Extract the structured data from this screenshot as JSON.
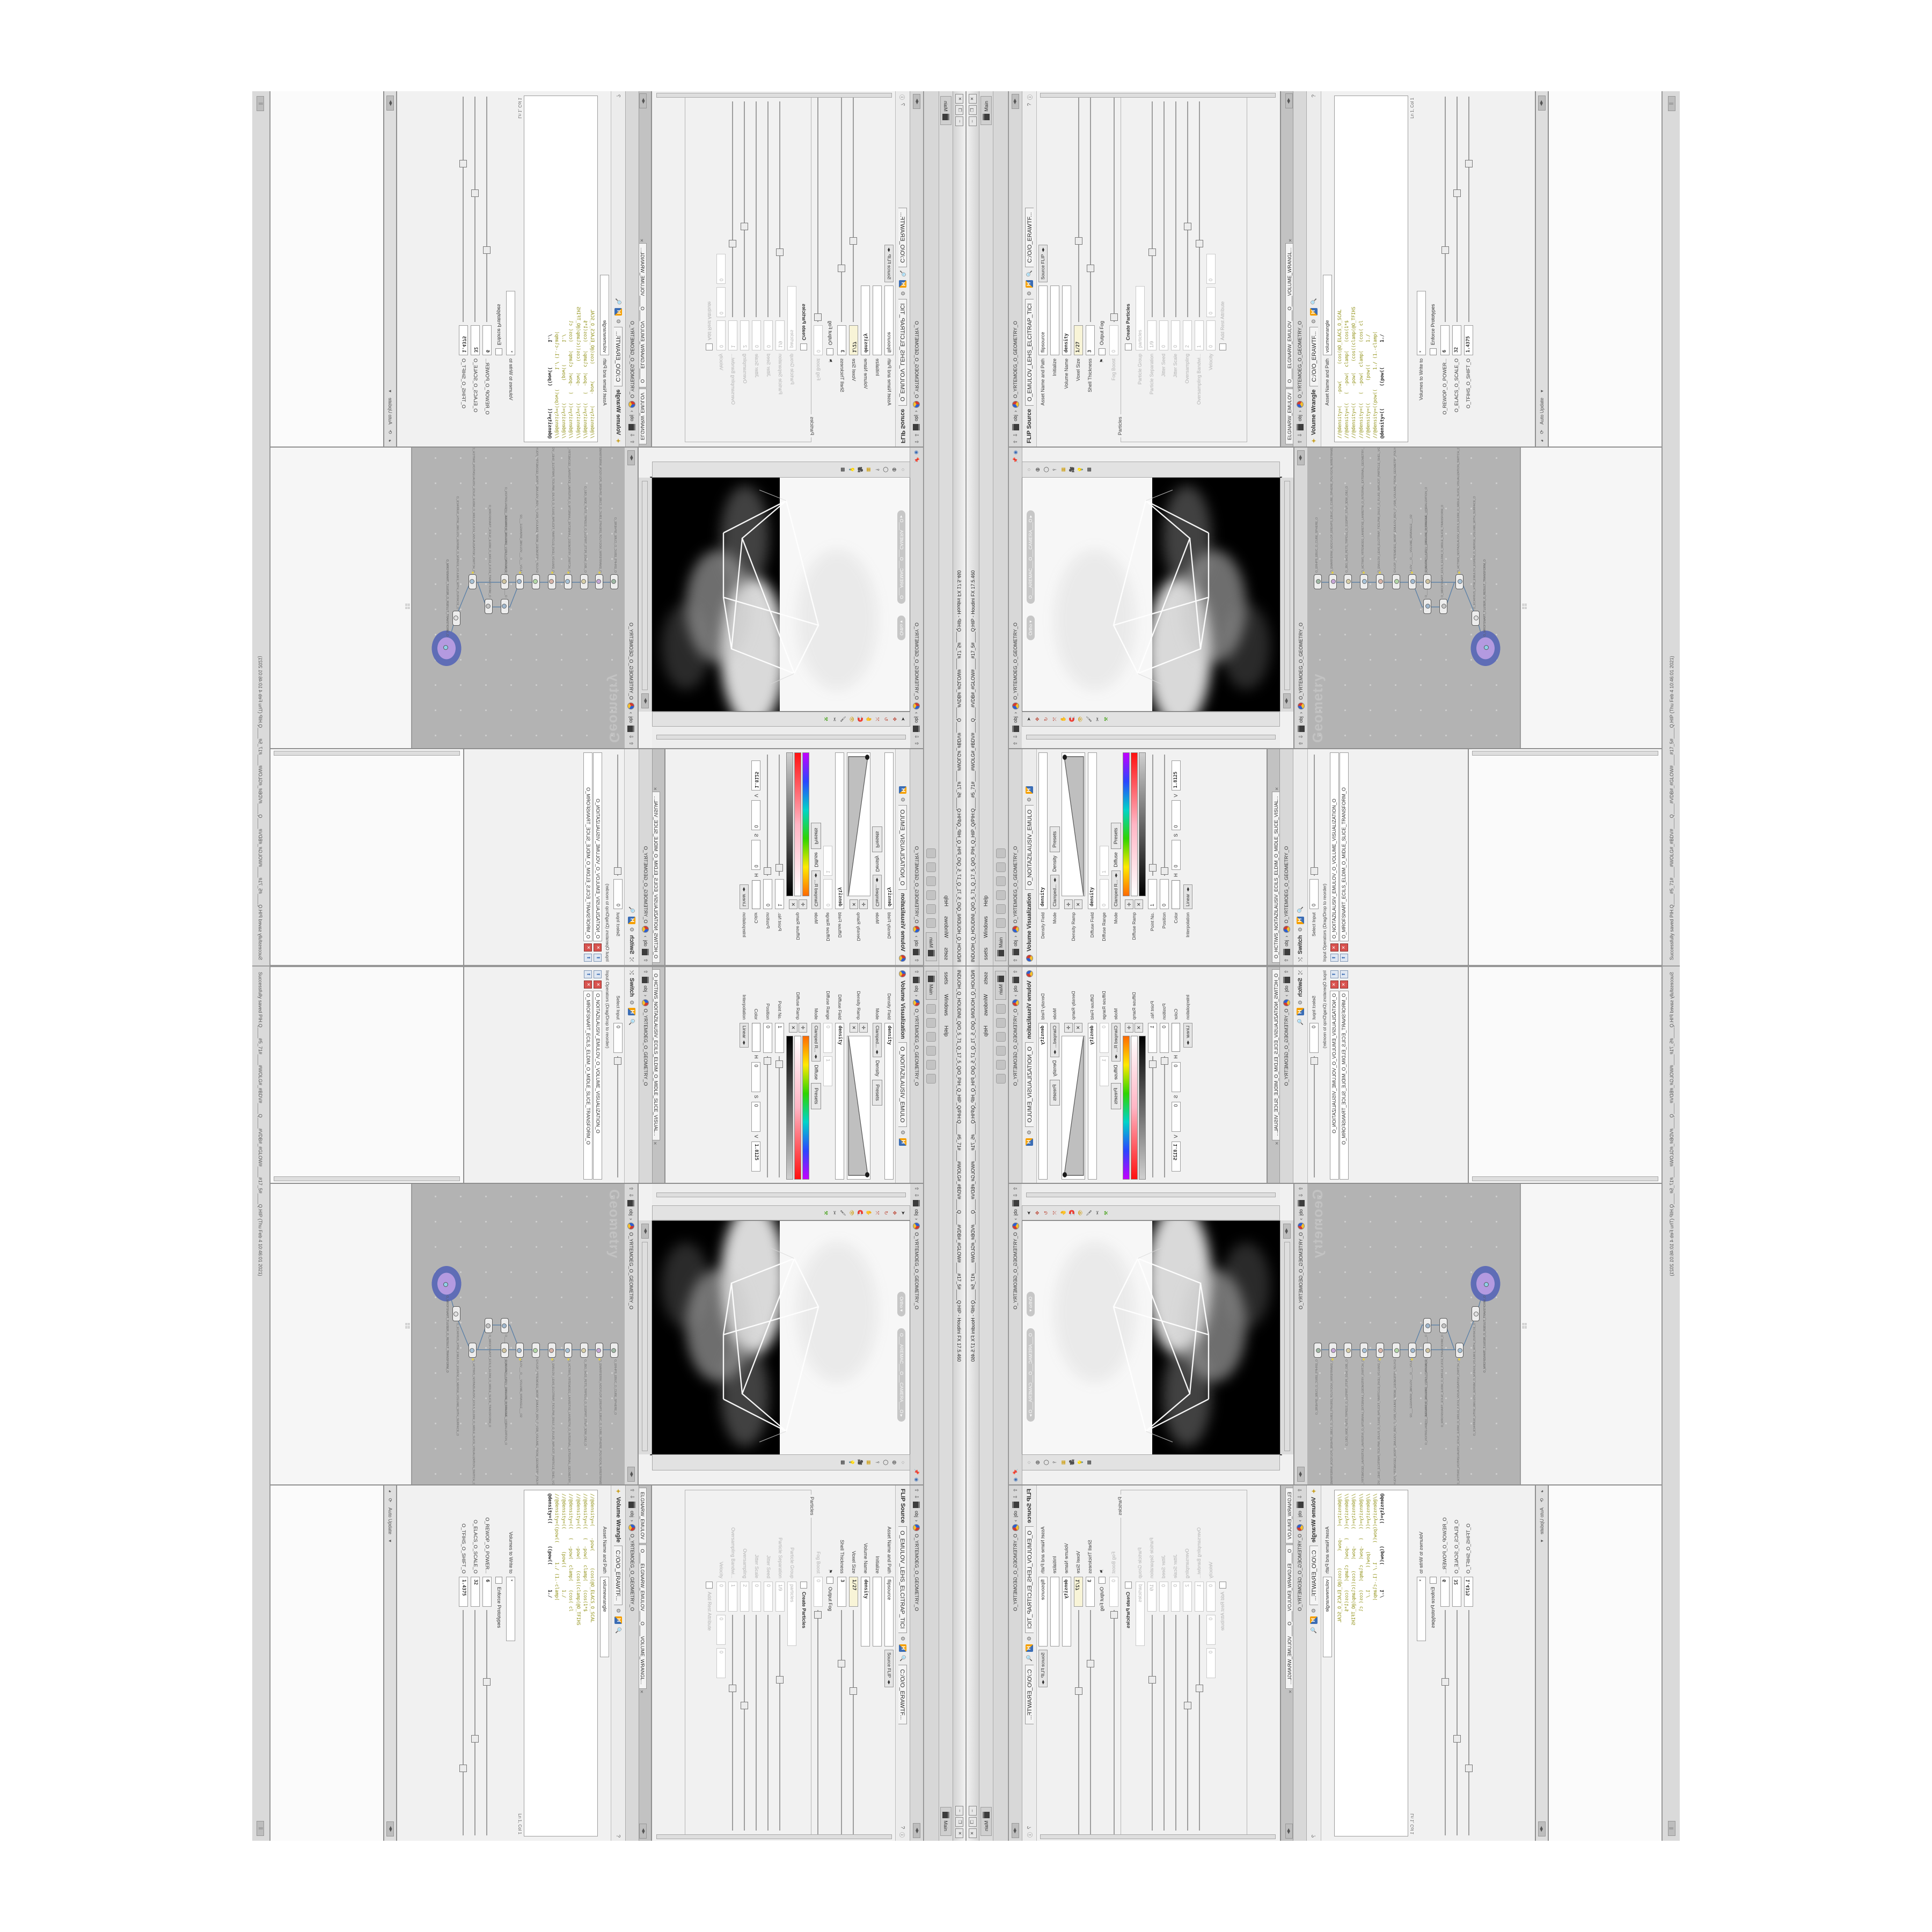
{
  "window": {
    "title": "INDUOH_Q_HOUDINI_Q/O_5_71_Q_17_5_Q/O_PIH_Q_HIP_Q/PIH:Q____#5_71#____#WOLG#_#BDV#____Q____#VDB#_#GLOW#____#17_5#____Q:HIP - Houdini FX 17.5.460",
    "buttons": {
      "min": "–",
      "max": "❐",
      "close": "✕"
    },
    "menu": [
      "ssets",
      "Windows",
      "Help"
    ],
    "main_tab": "Main",
    "shelf_tab": "Main",
    "status_message": "Successfully saved PIH.Q____#5_71#____#WOLG#_#BDV#____Q____#VDB#_#GLOW#____#17_5#____Q.HIP (Thu Feb  4 10:46:01 2021)",
    "auto_update": "Auto Update"
  },
  "breadcrumb": {
    "root": "obj",
    "path": "O_YRTEMOEG_O_GEOMETRY_O"
  },
  "flip": {
    "tab": "O_EMULOV_LEHS_ELCITRAP_TICI",
    "title": "FLIP Source",
    "path_tab": "C:/O/O_ERAWTF...",
    "rows": [
      {
        "l": "Asset Name and Path",
        "v": "flipsource",
        "v2": "Source FLIP"
      },
      {
        "l": "Initialize",
        "v": ""
      },
      {
        "l": "Volume Name",
        "v": "density"
      },
      {
        "l": "Voxel Size",
        "v": "1/27"
      },
      {
        "l": "Shell Thickness",
        "v": "3"
      },
      {
        "l": "",
        "v": "Output Fog"
      },
      {
        "l": "Fog Boost",
        "v": "0"
      }
    ],
    "particles_group": "Particles",
    "particle_rows": [
      {
        "l": "",
        "v": "Create Particles"
      },
      {
        "l": "Particle Group",
        "v": "particles"
      },
      {
        "l": "Particle Separation",
        "v": "1/9"
      },
      {
        "l": "Jitter Seed",
        "v": "0"
      },
      {
        "l": "Jitter Scale",
        "v": "0"
      },
      {
        "l": "Oversampling",
        "v": "2"
      },
      {
        "l": "Oversampling Bandwi...",
        "v": "1"
      },
      {
        "l": "Velocity",
        "v": "0"
      },
      {
        "l": "",
        "v": "Add Rest Attribute"
      }
    ]
  },
  "wrangle": {
    "tab": "O____ELGNARW_EMULOV____O____VOLUME_WRANGL...",
    "tab_left": "ELGNARW_EMULOV",
    "title": "Volume Wrangle",
    "path_tab": "C:/O/O_ERAWTF...",
    "asset_label": "Asset Name and Path",
    "asset_value": "volumewrangle",
    "code": {
      "lines": [
        "//@density=(    -pow(      (cos(@O_ELACS_O_SCAL",
        "//@density=((   (  -pow(  clamp(   (cos(1*$",
        "//@density=((      -pow(    (cos((clamp(@O_TFIHS",
        "//@density=((   (  -pow(  clamp(   (cos( cl",
        "//@density=((        (pow((        1./",
        "//@density=((pow((       1./ (1.-clamp(",
        "@density=((        ((pow((         1./"
      ]
    },
    "lncol": "Ln 1, Col 1",
    "volumes_label": "Volumes to Write to",
    "volumes_value": "*",
    "enforce": "Enforce Prototypes",
    "sliders": [
      {
        "l": "O_REWOP_O_POWER...",
        "v": "6"
      },
      {
        "l": "O_ELACS_O_SCALE_O",
        "v": "32"
      },
      {
        "l": "O_TFIHS_O_SHIFT_O",
        "v": "1.4375"
      }
    ]
  },
  "viz": {
    "tab": "O_NOITAZILAUSIV_EMULO",
    "title": "Volume Visualization",
    "density_field_label": "Density Field",
    "density_field": "density",
    "mode_label": "Mode",
    "mode1": "Clamped...",
    "mode1_tag": "Density",
    "presets": "Presets",
    "density_ramp_label": "Density Ramp",
    "diffuse_field_label": "Diffuse Field",
    "diffuse_field": "density",
    "diffuse_range_label": "Diffuse Range",
    "range0": "0",
    "range1": "1",
    "mode2": "Clamped R...",
    "mode2_tag": "Diffuse",
    "diffuse_ramp_label": "Diffuse Ramp",
    "diffuse_ramp_stops": [
      "#ff6a00",
      "#ffe900",
      "#2fd400",
      "#00d4c8",
      "#2b46ff",
      "#c400ff"
    ],
    "color_preview_stops": [
      "#ffffff",
      "#ffb5c4",
      "#ff1111"
    ],
    "value_ramp_stops": [
      "#000000",
      "#cfcfcf"
    ],
    "point_label": "Point No.",
    "point": "1",
    "pos_label": "Position",
    "pos": "0",
    "color_label": "Color",
    "h_label": "H",
    "h": "0",
    "s_label": "S",
    "s": "0",
    "v_label": "V",
    "v": "1.8125",
    "interp_label": "Interpolation",
    "interp": "Linear"
  },
  "switch": {
    "tab": "O_HCTIWS_NOITAZILAUSIV_ECILS_ELDIM_O_MIDLE_SLICE_VISUAL...",
    "title": "Switch",
    "select_label": "Select Input",
    "select_value": "0",
    "ops_label": "Input Operators (Drag/Drop to reorder)",
    "items": [
      "O_NOITAZILAUSIV_EMULOV_O_VOLUME_VISUALIZATION_O",
      "O_MROFSNART_ECILS_ELDIM_O_MIDLE_SLICE_TRANSFORM_O"
    ]
  },
  "viewport": {
    "ortho": "Ortho",
    "camera": "O___AREMAC___O___CAMERA___O"
  },
  "network": {
    "watermark": "Geometry",
    "nodes": [
      {
        "label": "O_ERHPS_EBUC_O_CUBE_SPHERE_O"
      },
      {
        "label": "O_EMARFERIW_NOGYLOP_EREHPS_EBUC_O_CUBE_SPHERE_POLYGON_WIREFRAME_O"
      },
      {
        "label": "O_JBO_WD3_PETS_TRPD1S_O_S1DPRT_STEP_3DW_OBJ_O"
      },
      {
        "label": "O_HCTIWS_YRTEMOEG_LANRETXE_LANRETNI_O_INTERNAL_EXTERNAL_GEOMETRY_SWITCH_O"
      },
      {
        "label": "O_EMULOV_LEHS_ELCITRAP_TICILPMI_DIULF_O_FLUID_IMPLICIT_PARTICLE_SHEL_VOLUME_O"
      },
      {
        "label": "GYLOP_YRTEMOEG_MORF_EMULOV_BDV_O_VDB_VOLUME_FROM_GEOMETRY_POLYGONS_O"
      },
      {
        "label": "ULOV___O___VOLUME_WRANGLE___O2"
      },
      {
        "label": "O____ELGNARW_EMULOV____O____VOLUME_WRANGLE____O"
      },
      {
        "label": "O_NOITAZILAUSIV_EMULOV_O_VOLUME_VISUALIZATION_O"
      },
      {
        "label": "O_MROFSNART_ECILS_ELDIM_O_MIDLE_SLICE_TRANSFORM_O"
      },
      {
        "label": "O_HCTIWS_NOITAZILAUSIV_ECILS_ELDIM_O_MIDLE_SLICE_VISUALIZATION_SWITCH_O"
      },
      {
        "label": "O_ECAFRUS_HTIW_EMULOV_EGREM_O_MERGE_VOLUME_WITH_SURFACE_O"
      },
      {
        "label": "O_MROFSNART_TLUSER_O_RESULT_TRANSFORM_O"
      }
    ]
  },
  "colors": {
    "network_bg": "#b3b3b3",
    "code_text": "#8f8f13",
    "halo_outer": "#5f6db6",
    "halo_inner": "#b49ae0",
    "voxel_field_bg": "#f8f4d7",
    "wire": "#5e82a8"
  }
}
